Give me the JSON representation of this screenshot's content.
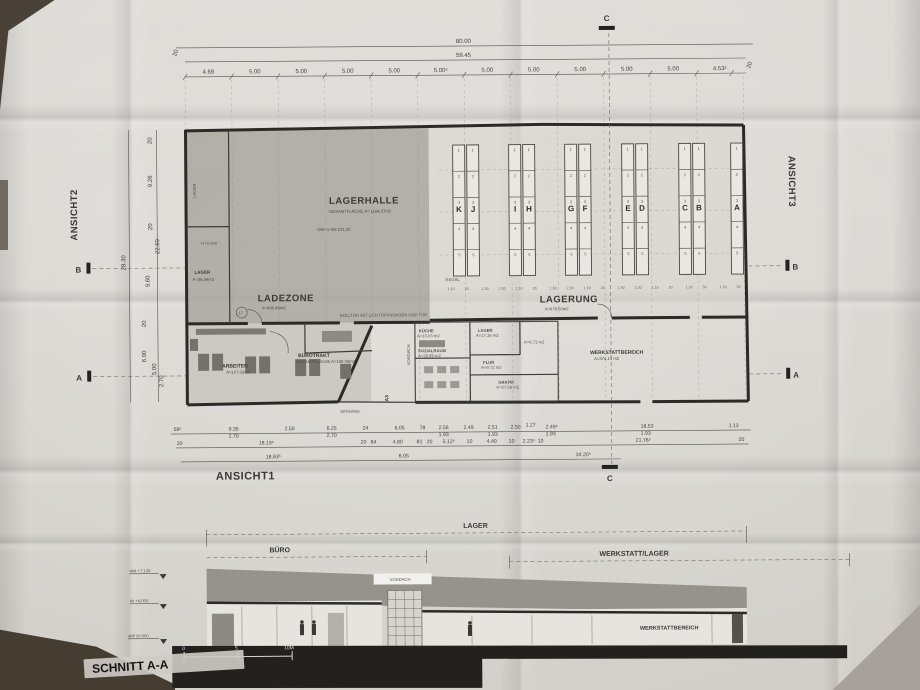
{
  "plan": {
    "hall": {
      "name": "LAGERHALLE",
      "area": "GESAMTFLÄCHE A= 1164.37m2",
      "level": "OKF ü NN 101.20"
    },
    "ladezone": {
      "name": "LADEZONE",
      "area": "A=438.46m2"
    },
    "lagerung": {
      "name": "LAGERUNG",
      "area": "A=679.50m2"
    },
    "regal_label": "REGAL",
    "rolltor_note": "ROLLTOR MIT LICHTÖFFNUNGEN UND TOR",
    "lager_corner": "LAGER",
    "lager_room": {
      "name": "LAGER",
      "area": "A=46.56m2",
      "height": "H=2.900"
    },
    "circle_note": "17",
    "buerotrakt": {
      "name": "BÜROTRAKT",
      "area": "GESAMTFLÄCHE A=158.06m2"
    },
    "arbeiten": {
      "name": "ARBEITEN",
      "area": "A=107.02m2"
    },
    "eingang": "EINGANG",
    "a3": "A3",
    "vordach": "VORDACH",
    "kueche": {
      "name": "KÜCHE",
      "area": "A=13.03 m2"
    },
    "lager_mid": {
      "name": "LAGER",
      "area": "A=17.16 m2"
    },
    "wc": {
      "area": "A=6.71 m2"
    },
    "sozialraum": {
      "name": "SOZIALRAUM",
      "area": "A=29.89 m2"
    },
    "flur": {
      "name": "FLUR",
      "area": "A=9.72 m2"
    },
    "grafik": {
      "name": "GRAFIK",
      "area": "A=27.56 m2"
    },
    "werkstatt": {
      "name": "WERKSTATTBEREICH",
      "area": "A=374.13 m2"
    },
    "racks": {
      "letters": [
        "K",
        "J",
        "I",
        "H",
        "G",
        "F",
        "E",
        "D",
        "C",
        "B",
        "A"
      ],
      "cells": [
        "1",
        "2",
        "3",
        "4",
        "5"
      ]
    }
  },
  "views": {
    "ansicht1": "ANSICHT1",
    "ansicht2": "ANSICHT2",
    "ansicht3": "ANSICHT3"
  },
  "markers": {
    "a": "A",
    "b": "B",
    "c": "C"
  },
  "dims": {
    "top_total": "80.00",
    "top_inner": "59.45",
    "top": [
      "4.69",
      "5.00",
      "5.00",
      "5.00",
      "5.00",
      "5.00⁵",
      "5.00",
      "5.00",
      "5.00",
      "5.00",
      "5.00",
      "4.53¹"
    ],
    "top_end_left": "20",
    "top_end_right": "20",
    "left": [
      "20",
      "9.26",
      "20",
      "22.69",
      "28.30",
      "9.60",
      "20",
      "6.00",
      "5.00",
      "2.70"
    ],
    "bottom_r1": [
      "59⁵",
      "9.35",
      "2.70",
      "2.50",
      "6.25",
      "2.70",
      "24",
      "6.05",
      "78",
      "2.56",
      "1.93",
      "2.49",
      "2.51",
      "1.93",
      "2.50",
      "1.27",
      "2.49⁵",
      "1.93",
      "18.53",
      "1.93",
      "1.13"
    ],
    "bottom_r2": [
      "20",
      "18.13⁵",
      "20",
      "84",
      "4.80",
      "81",
      "20",
      "5.12⁵",
      "10",
      "4.40",
      "10",
      "2.23⁵",
      "10",
      "21.76⁵",
      "20"
    ],
    "bottom_r3": [
      "18.63⁵",
      "6.05",
      "34.20⁵"
    ],
    "rack_dims": [
      "1.10",
      "20",
      "1.30",
      "2.20",
      "1.10",
      "20",
      "1.50",
      "2.20",
      "1.10",
      "20",
      "1.50",
      "2.20",
      "1.10",
      "20",
      "1.30",
      "50",
      "1.20",
      "50"
    ]
  },
  "section": {
    "title": "SCHNITT A-A",
    "bracket_lager": "LAGER",
    "bracket_buero": "BÜRO",
    "bracket_werkstatt": "WERKSTATT/LAGER",
    "vordach": "VORDACH",
    "werkstattbereich": "WERKSTATTBEREICH",
    "levels": [
      "okd +7.135",
      "ok +4.000",
      "okff ±0.000"
    ],
    "scale": [
      "0",
      "5",
      "10M"
    ]
  }
}
